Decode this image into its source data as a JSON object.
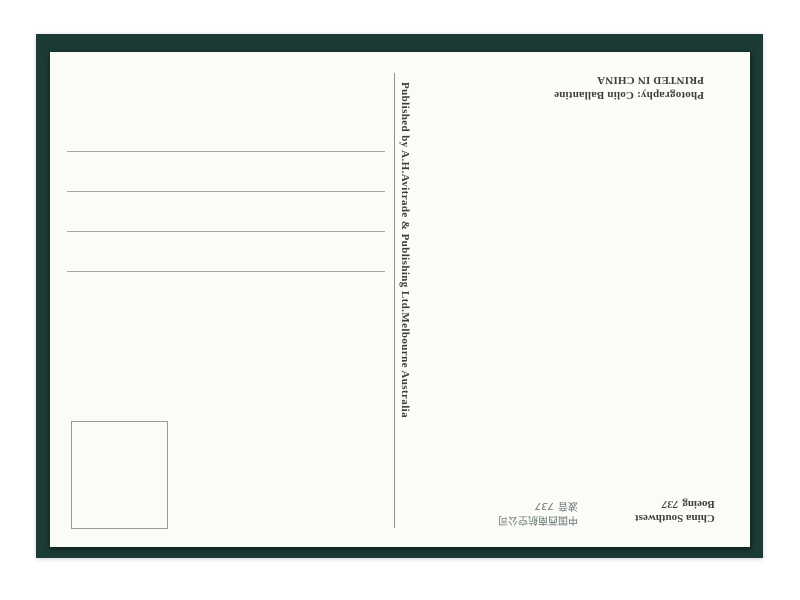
{
  "postcard": {
    "photo_credit_line": "Photography: Colin Ballantine",
    "printed_line": "PRINTED IN CHINA",
    "publisher_line": "Published by A.H.Avitrade & Publishing Ltd.Melbourne Australia",
    "caption_en": {
      "airline": "China Southwest",
      "aircraft": "Boeing",
      "model": "737"
    },
    "caption_cn": {
      "airline": "中国西南航空公司",
      "aircraft": "波音",
      "model": "737"
    },
    "address_line_count": 4,
    "orientation": "card scanned upside-down (rotated 180°)",
    "colors": {
      "mat_green": "#1c3b34",
      "card_white": "#fbfbf8",
      "ink": "#3d3f3e",
      "rule_gray": "#a6a6a3"
    }
  }
}
